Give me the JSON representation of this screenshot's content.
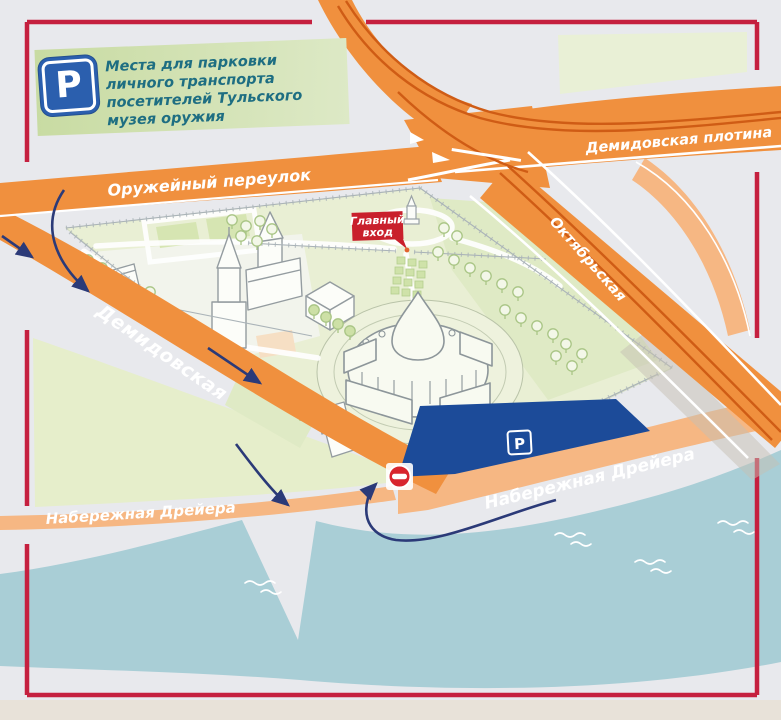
{
  "legend": {
    "parking_symbol": "P",
    "text": "Места для парковки личного транспорта посетителей Тульского музея оружия",
    "icon": "parking-sign"
  },
  "roads": {
    "oruzheyny_pereulok": "Оружейный переулок",
    "demidovskaya_plotina": "Демидовская плотина",
    "oktyabrskaya": "Октябрьская",
    "demidovskaya": "Демидовская",
    "naberezhnaya_dreyera_west": "Набережная Дрейера",
    "naberezhnaya_dreyera_east": "Набережная Дрейера"
  },
  "entrance": {
    "line1": "Главный",
    "line2": "вход"
  },
  "parking_lot": {
    "symbol": "P",
    "icon": "parking-sign"
  },
  "signs": {
    "no_entry_icon": "no-entry-sign"
  },
  "colors": {
    "road_orange": "#f0903e",
    "road_light_orange": "#f6b783",
    "road_stripe_dark": "#cf5c15",
    "frame_red": "#c5203f",
    "parking_blue": "#1c4b99",
    "river_teal": "#a9ced6",
    "park_green": "#e9efd4",
    "accent_red": "#c9202c",
    "legend_green": "#d2e1b0",
    "legend_text": "#1e6e82",
    "arrow_navy": "#2b3a78"
  },
  "map": {
    "trees": [
      [
        438,
        252
      ],
      [
        454,
        260
      ],
      [
        470,
        268
      ],
      [
        486,
        276
      ],
      [
        502,
        284
      ],
      [
        518,
        292
      ],
      [
        505,
        310
      ],
      [
        521,
        318
      ],
      [
        537,
        326
      ],
      [
        553,
        334
      ],
      [
        566,
        344
      ],
      [
        582,
        354
      ],
      [
        556,
        356
      ],
      [
        572,
        366
      ],
      [
        232,
        220
      ],
      [
        246,
        226
      ],
      [
        260,
        221
      ],
      [
        272,
        229
      ],
      [
        241,
        236
      ],
      [
        257,
        241
      ],
      [
        444,
        228
      ],
      [
        457,
        236
      ],
      [
        88,
        260
      ],
      [
        102,
        268
      ],
      [
        150,
        292
      ],
      [
        300,
        412
      ]
    ],
    "filled_trees": [
      [
        314,
        310
      ],
      [
        326,
        317
      ],
      [
        338,
        324
      ],
      [
        350,
        331
      ]
    ],
    "waves": [
      [
        245,
        583
      ],
      [
        555,
        535
      ],
      [
        635,
        562
      ],
      [
        718,
        523
      ]
    ]
  }
}
